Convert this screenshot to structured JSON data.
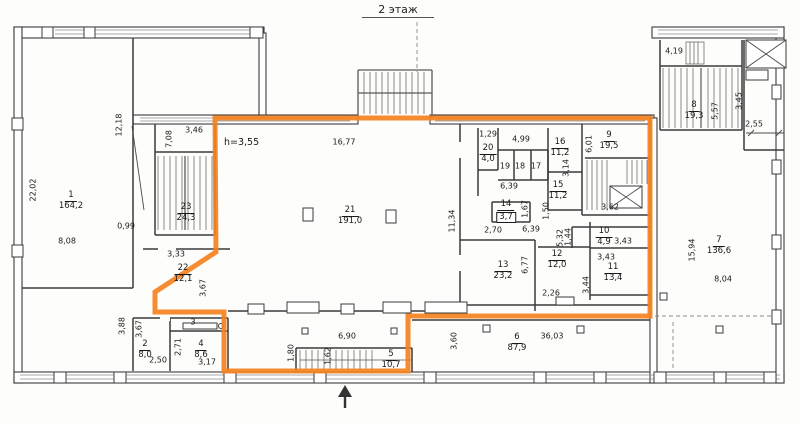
{
  "title": "2 этаж",
  "height_note": "h=3,55",
  "highlight_color": "#f5821f",
  "room_labels": [
    {
      "n": "1",
      "a": "164,2",
      "x": 71,
      "y": 191
    },
    {
      "n": "23",
      "a": "24,3",
      "x": 186,
      "y": 203
    },
    {
      "n": "22",
      "a": "12,1",
      "x": 183,
      "y": 264
    },
    {
      "n": "2",
      "a": "8,0",
      "x": 145,
      "y": 340
    },
    {
      "n": "4",
      "a": "8,6",
      "x": 201,
      "y": 340
    },
    {
      "n": "5",
      "a": "10,7",
      "x": 391,
      "y": 350
    },
    {
      "n": "6",
      "a": "87,9",
      "x": 517,
      "y": 333
    },
    {
      "n": "21",
      "a": "191,0",
      "x": 350,
      "y": 206
    },
    {
      "n": "13",
      "a": "23,2",
      "x": 503,
      "y": 261
    },
    {
      "n": "12",
      "a": "12,0",
      "x": 557,
      "y": 250
    },
    {
      "n": "14",
      "a": "3,7",
      "x": 506,
      "y": 200,
      "boxed": true
    },
    {
      "n": "16",
      "a": "11,2",
      "x": 560,
      "y": 138
    },
    {
      "n": "15",
      "a": "11,2",
      "x": 558,
      "y": 181
    },
    {
      "n": "20",
      "a": "4,0",
      "x": 488,
      "y": 144
    },
    {
      "n": "9",
      "a": "19,5",
      "x": 609,
      "y": 131
    },
    {
      "n": "10",
      "a": "4,9",
      "x": 604,
      "y": 227
    },
    {
      "n": "11",
      "a": "13,4",
      "x": 613,
      "y": 263
    },
    {
      "n": "8",
      "a": "19,3",
      "x": 694,
      "y": 101
    },
    {
      "n": "7",
      "a": "136,6",
      "x": 719,
      "y": 236
    }
  ],
  "plain_labels": [
    {
      "t": "3",
      "x": 193,
      "y": 322
    },
    {
      "t": "19",
      "x": 505,
      "y": 166
    },
    {
      "t": "18",
      "x": 520,
      "y": 166
    },
    {
      "t": "17",
      "x": 536,
      "y": 166
    },
    {
      "t": "22,02",
      "x": 33,
      "y": 190,
      "rot": 1
    },
    {
      "t": "12,18",
      "x": 119,
      "y": 125,
      "rot": 1
    },
    {
      "t": "8,08",
      "x": 67,
      "y": 241
    },
    {
      "t": "0,99",
      "x": 126,
      "y": 226
    },
    {
      "t": "3,33",
      "x": 176,
      "y": 254
    },
    {
      "t": "3,46",
      "x": 194,
      "y": 130
    },
    {
      "t": "7,08",
      "x": 169,
      "y": 139,
      "rot": 1
    },
    {
      "t": "16,77",
      "x": 344,
      "y": 142
    },
    {
      "t": "11,34",
      "x": 452,
      "y": 221,
      "rot": 1
    },
    {
      "t": "1,29",
      "x": 488,
      "y": 134
    },
    {
      "t": "4,99",
      "x": 521,
      "y": 139
    },
    {
      "t": "6,39",
      "x": 509,
      "y": 186
    },
    {
      "t": "6,39",
      "x": 531,
      "y": 229
    },
    {
      "t": "2,70",
      "x": 493,
      "y": 230
    },
    {
      "t": "3,14",
      "x": 566,
      "y": 168,
      "rot": 1
    },
    {
      "t": "6,01",
      "x": 589,
      "y": 144,
      "rot": 1
    },
    {
      "t": "1,67",
      "x": 525,
      "y": 209,
      "rot": 1
    },
    {
      "t": "1,50",
      "x": 546,
      "y": 211,
      "rot": 1
    },
    {
      "t": "5,32",
      "x": 560,
      "y": 238,
      "rot": 1
    },
    {
      "t": "6,77",
      "x": 525,
      "y": 265,
      "rot": 1
    },
    {
      "t": "1,44",
      "x": 568,
      "y": 237,
      "rot": 1
    },
    {
      "t": "3,62",
      "x": 610,
      "y": 207
    },
    {
      "t": "3,43",
      "x": 623,
      "y": 241
    },
    {
      "t": "3,43",
      "x": 606,
      "y": 257
    },
    {
      "t": "3,44",
      "x": 586,
      "y": 285,
      "rot": 1
    },
    {
      "t": "2,26",
      "x": 551,
      "y": 293
    },
    {
      "t": "4,19",
      "x": 674,
      "y": 51
    },
    {
      "t": "5,57",
      "x": 715,
      "y": 111,
      "rot": 1
    },
    {
      "t": "3,45",
      "x": 739,
      "y": 101,
      "rot": 1
    },
    {
      "t": "2,55",
      "x": 754,
      "y": 124
    },
    {
      "t": "15,94",
      "x": 692,
      "y": 250,
      "rot": 1
    },
    {
      "t": "8,04",
      "x": 723,
      "y": 279
    },
    {
      "t": "1,80",
      "x": 291,
      "y": 353,
      "rot": 1
    },
    {
      "t": "6,90",
      "x": 347,
      "y": 336
    },
    {
      "t": "1,62",
      "x": 328,
      "y": 356,
      "rot": 1
    },
    {
      "t": "3,60",
      "x": 454,
      "y": 341,
      "rot": 1
    },
    {
      "t": "36,03",
      "x": 552,
      "y": 336
    },
    {
      "t": "3,88",
      "x": 122,
      "y": 326,
      "rot": 1
    },
    {
      "t": "3,67",
      "x": 139,
      "y": 329,
      "rot": 1
    },
    {
      "t": "2,50",
      "x": 158,
      "y": 360
    },
    {
      "t": "2,71",
      "x": 178,
      "y": 347,
      "rot": 1
    },
    {
      "t": "3,17",
      "x": 207,
      "y": 362
    },
    {
      "t": "3,67",
      "x": 203,
      "y": 288,
      "rot": 1
    }
  ]
}
